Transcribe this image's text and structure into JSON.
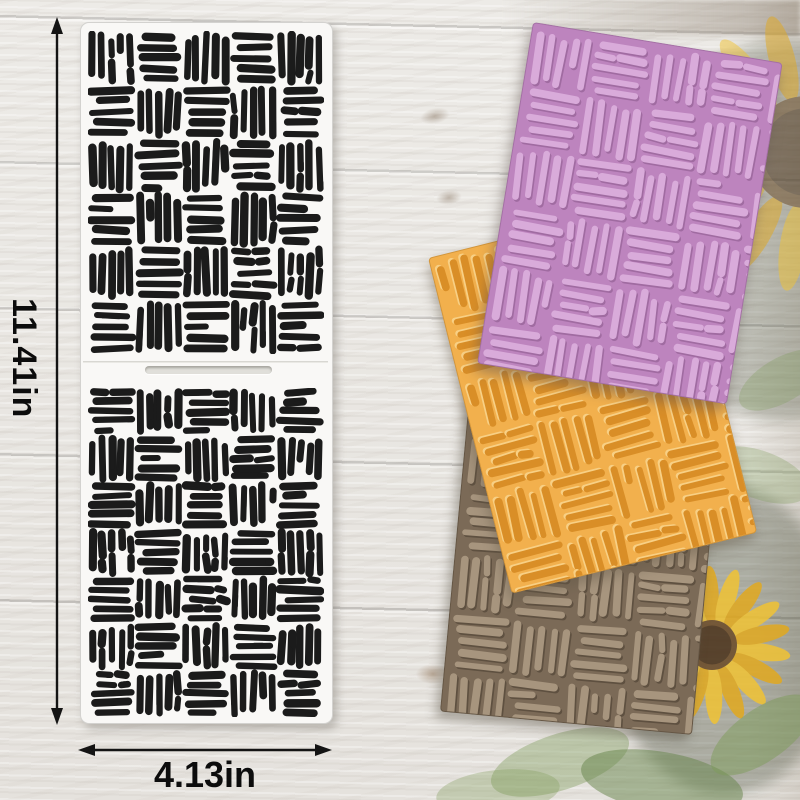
{
  "dimensions": {
    "height_label": "11.41in",
    "width_label": "4.13in",
    "arrow_color": "#141414",
    "label_color": "#0c0c0c"
  },
  "stencil": {
    "panel_fill": "#f9f8f6",
    "panel_border": "#d3d2cf",
    "ink": "#1b1b1b",
    "slot_fill": "#e0dfda",
    "top_pattern": {
      "cols": 5,
      "rows": 6,
      "cell_w": 47.2,
      "cell_h": 53.8,
      "first": "v",
      "seed": 7,
      "stroke_w": 7.2,
      "pad": 2.5,
      "rough": true
    },
    "bottom_pattern": {
      "cols": 5,
      "rows": 7,
      "cell_w": 47.2,
      "cell_h": 47,
      "first": "h",
      "seed": 13,
      "stroke_w": 7.2,
      "pad": 2.5,
      "rough": true
    }
  },
  "cards": [
    {
      "id": "purple",
      "bg": "#bd84be",
      "ink": "#d9abda",
      "relief": "#a06ba1",
      "relief_mode": "shade",
      "left": 533,
      "top": 22,
      "rot": 9.3,
      "w": 251,
      "h": 344,
      "pattern": {
        "cols": 5,
        "rows": 6,
        "cell_w": 60,
        "cell_h": 60,
        "first": "v",
        "seed": 21,
        "stroke_w": 7,
        "pad": 4
      }
    },
    {
      "id": "orange",
      "bg": "#f2b04d",
      "ink": "#d98e27",
      "relief": "#f8d085",
      "relief_mode": "highlight",
      "left": 428,
      "top": 258,
      "rot": -14,
      "w": 251,
      "h": 344,
      "pattern": {
        "cols": 5,
        "rows": 6,
        "cell_w": 60,
        "cell_h": 60,
        "first": "v",
        "seed": 33,
        "stroke_w": 7,
        "pad": 4
      }
    },
    {
      "id": "brown",
      "bg": "#7b6a57",
      "ink": "#a7957e",
      "relief": "#5e5040",
      "relief_mode": "shade",
      "left": 472,
      "top": 367,
      "rot": 5.3,
      "w": 251,
      "h": 344,
      "pattern": {
        "cols": 5,
        "rows": 6,
        "cell_w": 60,
        "cell_h": 60,
        "first": "h",
        "seed": 44,
        "stroke_w": 7,
        "pad": 4
      }
    }
  ],
  "photo": {
    "petal": "#f1c334",
    "petal_deep": "#e2a91f",
    "flower_center": "#4a3119",
    "center_ring": "#6b4a26",
    "leaf": "#7e9c59",
    "leaf_dark": "#66834a",
    "backdrop": "#39402c",
    "flowers": [
      {
        "cx": 806,
        "cy": 152,
        "center_r": 56,
        "petal_len": 88,
        "petal_w": 26,
        "petals": 16,
        "opacity": 0.5
      },
      {
        "cx": 712,
        "cy": 645,
        "center_r": 25,
        "petal_len": 58,
        "petal_w": 17,
        "petals": 18,
        "opacity": 0.85
      }
    ]
  }
}
